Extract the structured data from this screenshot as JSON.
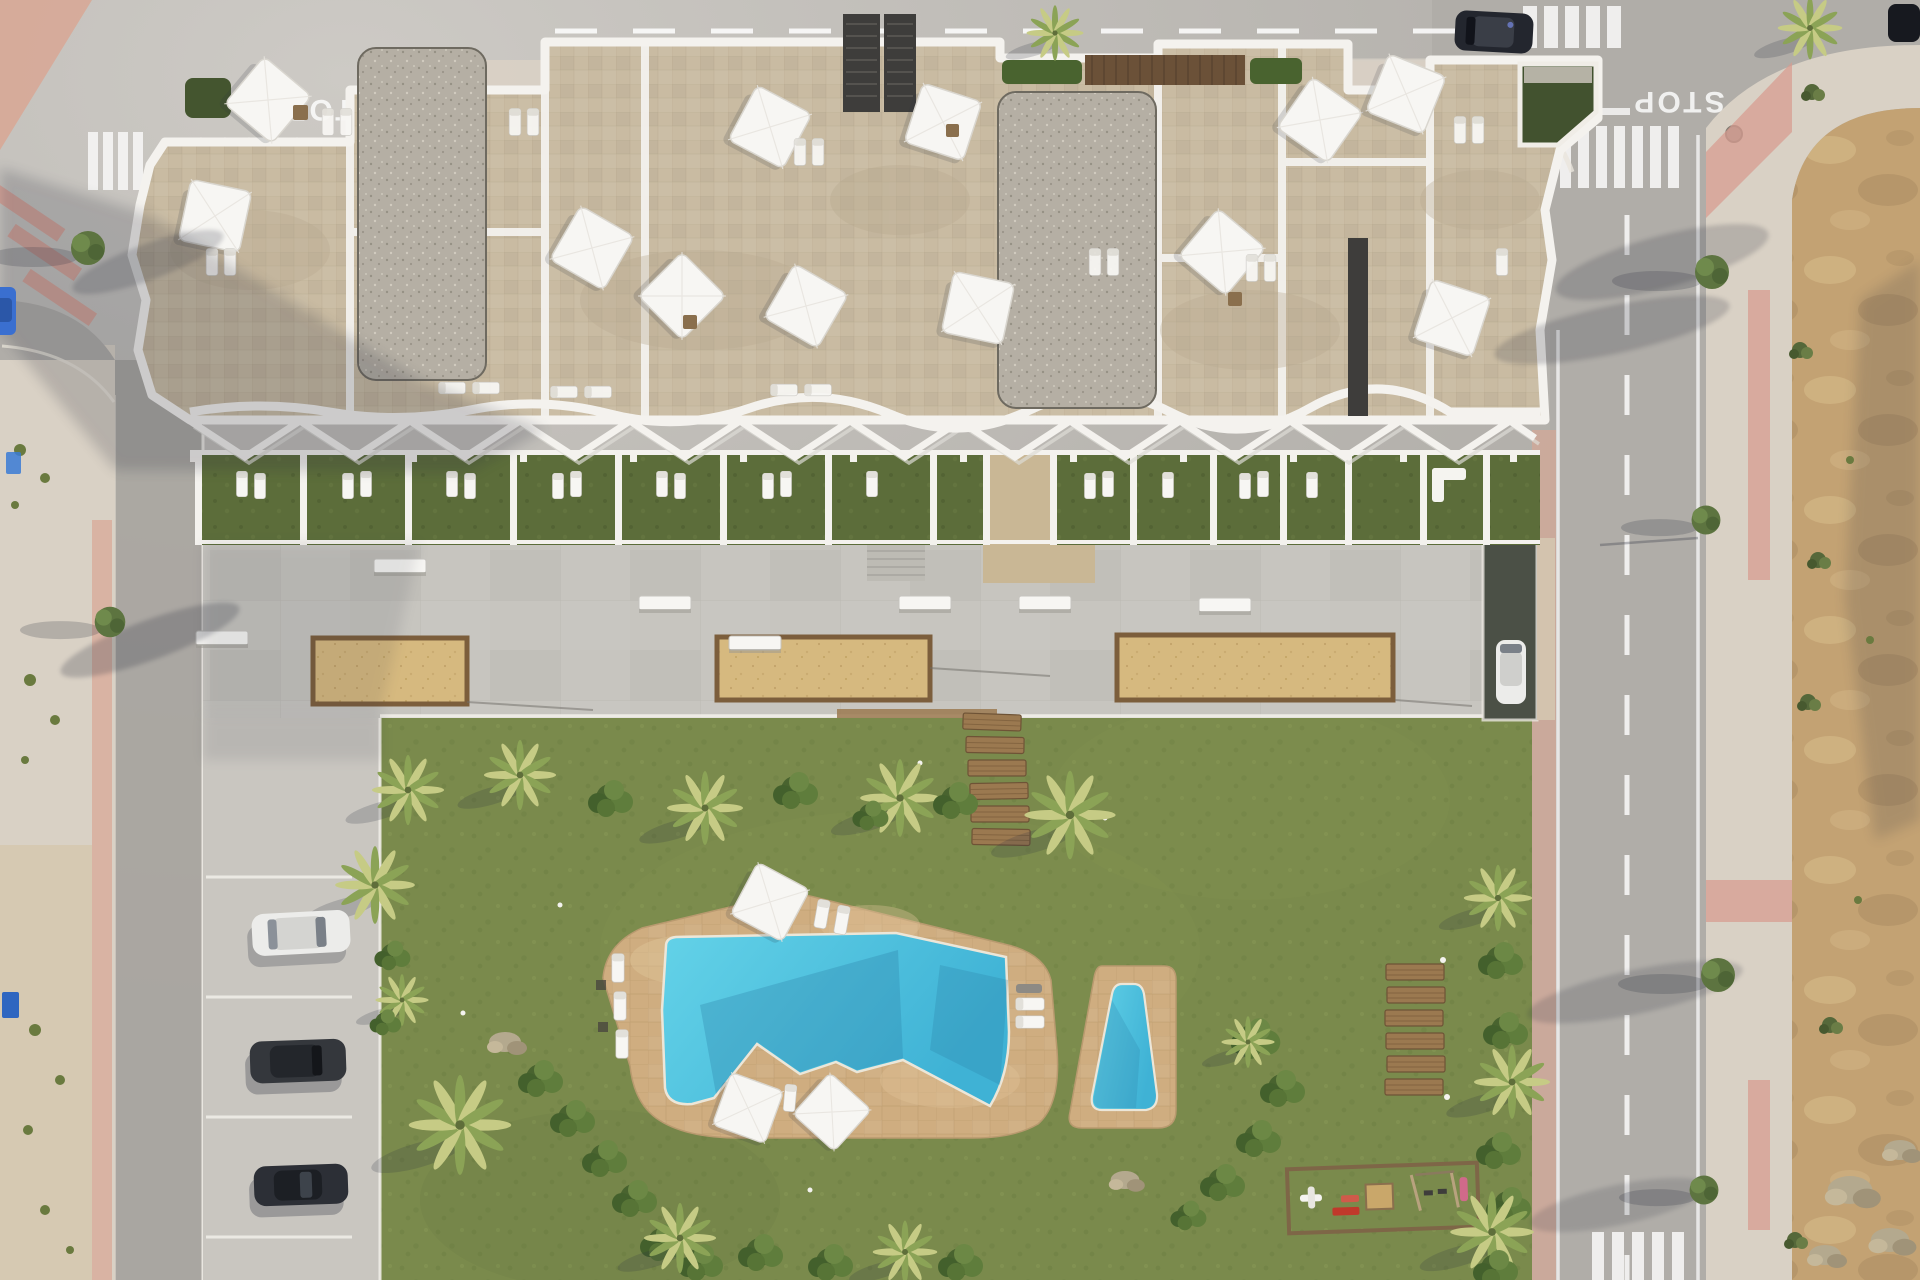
{
  "scene": {
    "title": "Top-down aerial render of a new-build apartment complex with rooftop terraces, communal garden, lagoon pool and kids pool, bordered by streets and an undeveloped dirt plot",
    "view": "drone top-down",
    "time": "sunny day, long shadows to the lower-left"
  },
  "markings": {
    "stop": "STOP"
  },
  "colors": {
    "asphalt": "#b0ada8",
    "asphaltLight": "#cdcac5",
    "street": "#a8a5a0",
    "sidewalk": "#d9d1c5",
    "sidewalkPink": "#d8a794",
    "dirt": "#c3a273",
    "dirtLight": "#d9c08e",
    "dirtDark": "#a3855c",
    "grass": "#7a8a4c",
    "grassDark": "#5f7239",
    "gardenGrass": "#5c6d3a",
    "hedge": "#49632f",
    "palmLight": "#c6cb85",
    "palmDark": "#8ba356",
    "deck": "#c7c5bf",
    "deckLine": "#b3b1ab",
    "stone": "#c9bba2",
    "stoneLine": "#b5a88c",
    "gravel": "#b5afa4",
    "gravelDot": "#8f897d",
    "parapet": "#f4f2ee",
    "charcoal": "#3e3d3b",
    "brown": "#6b5138",
    "poolDeck": "#cfad80",
    "poolDeckLine": "#ba9a6d",
    "poolWater": "#63d2e8",
    "poolDeep": "#3fb2d5",
    "courtSand": "#d6b97f",
    "courtBorder": "#7c5e3c",
    "wood": "#9b7950",
    "white": "#f7f6f3",
    "sand": "#d9c49a",
    "shadow": "#2e3240",
    "carWhite": "#ececea",
    "carDark": "#34373c",
    "carNavy": "#23262e",
    "carBlue": "#3a6fd0",
    "ramp": "#4b5046"
  },
  "objects": {
    "building": {
      "label": "white apartment block with stone-tiled rooftop terraces",
      "rooftop_umbrellas": 12,
      "rooftop_stairwell_boxes": 2,
      "gravel_roof_slabs": 2,
      "green_roof_patches": 2,
      "private_garden_terraces": 15,
      "pergola": "white zigzag beam canopy over ground-floor gardens"
    },
    "amenities": {
      "main_pool": "organic lagoon-shaped pool on tan stone deck",
      "kids_pool": "small teardrop pool on its own deck",
      "petanque_courts": 3,
      "playground": "sand playground with spring rider, red bench, playhouse and swing set",
      "wooden_steps_to_pool": 6,
      "wooden_lawn_benches": 6,
      "deck_benches": 6
    },
    "vehicles": {
      "parked_cars_in_bays": 3,
      "car_on_ramp": 1,
      "cars_on_top_road": 2,
      "blue_car_left_edge": 1
    },
    "roads": {
      "stop_markings": 2,
      "crosswalks": 5,
      "dashed_lane_lines": 3
    },
    "vegetation": {
      "palm_clusters": "belts around lawn and along right road",
      "street_trees": 6,
      "hedges": "diagonal hedge rows across lawn"
    }
  }
}
